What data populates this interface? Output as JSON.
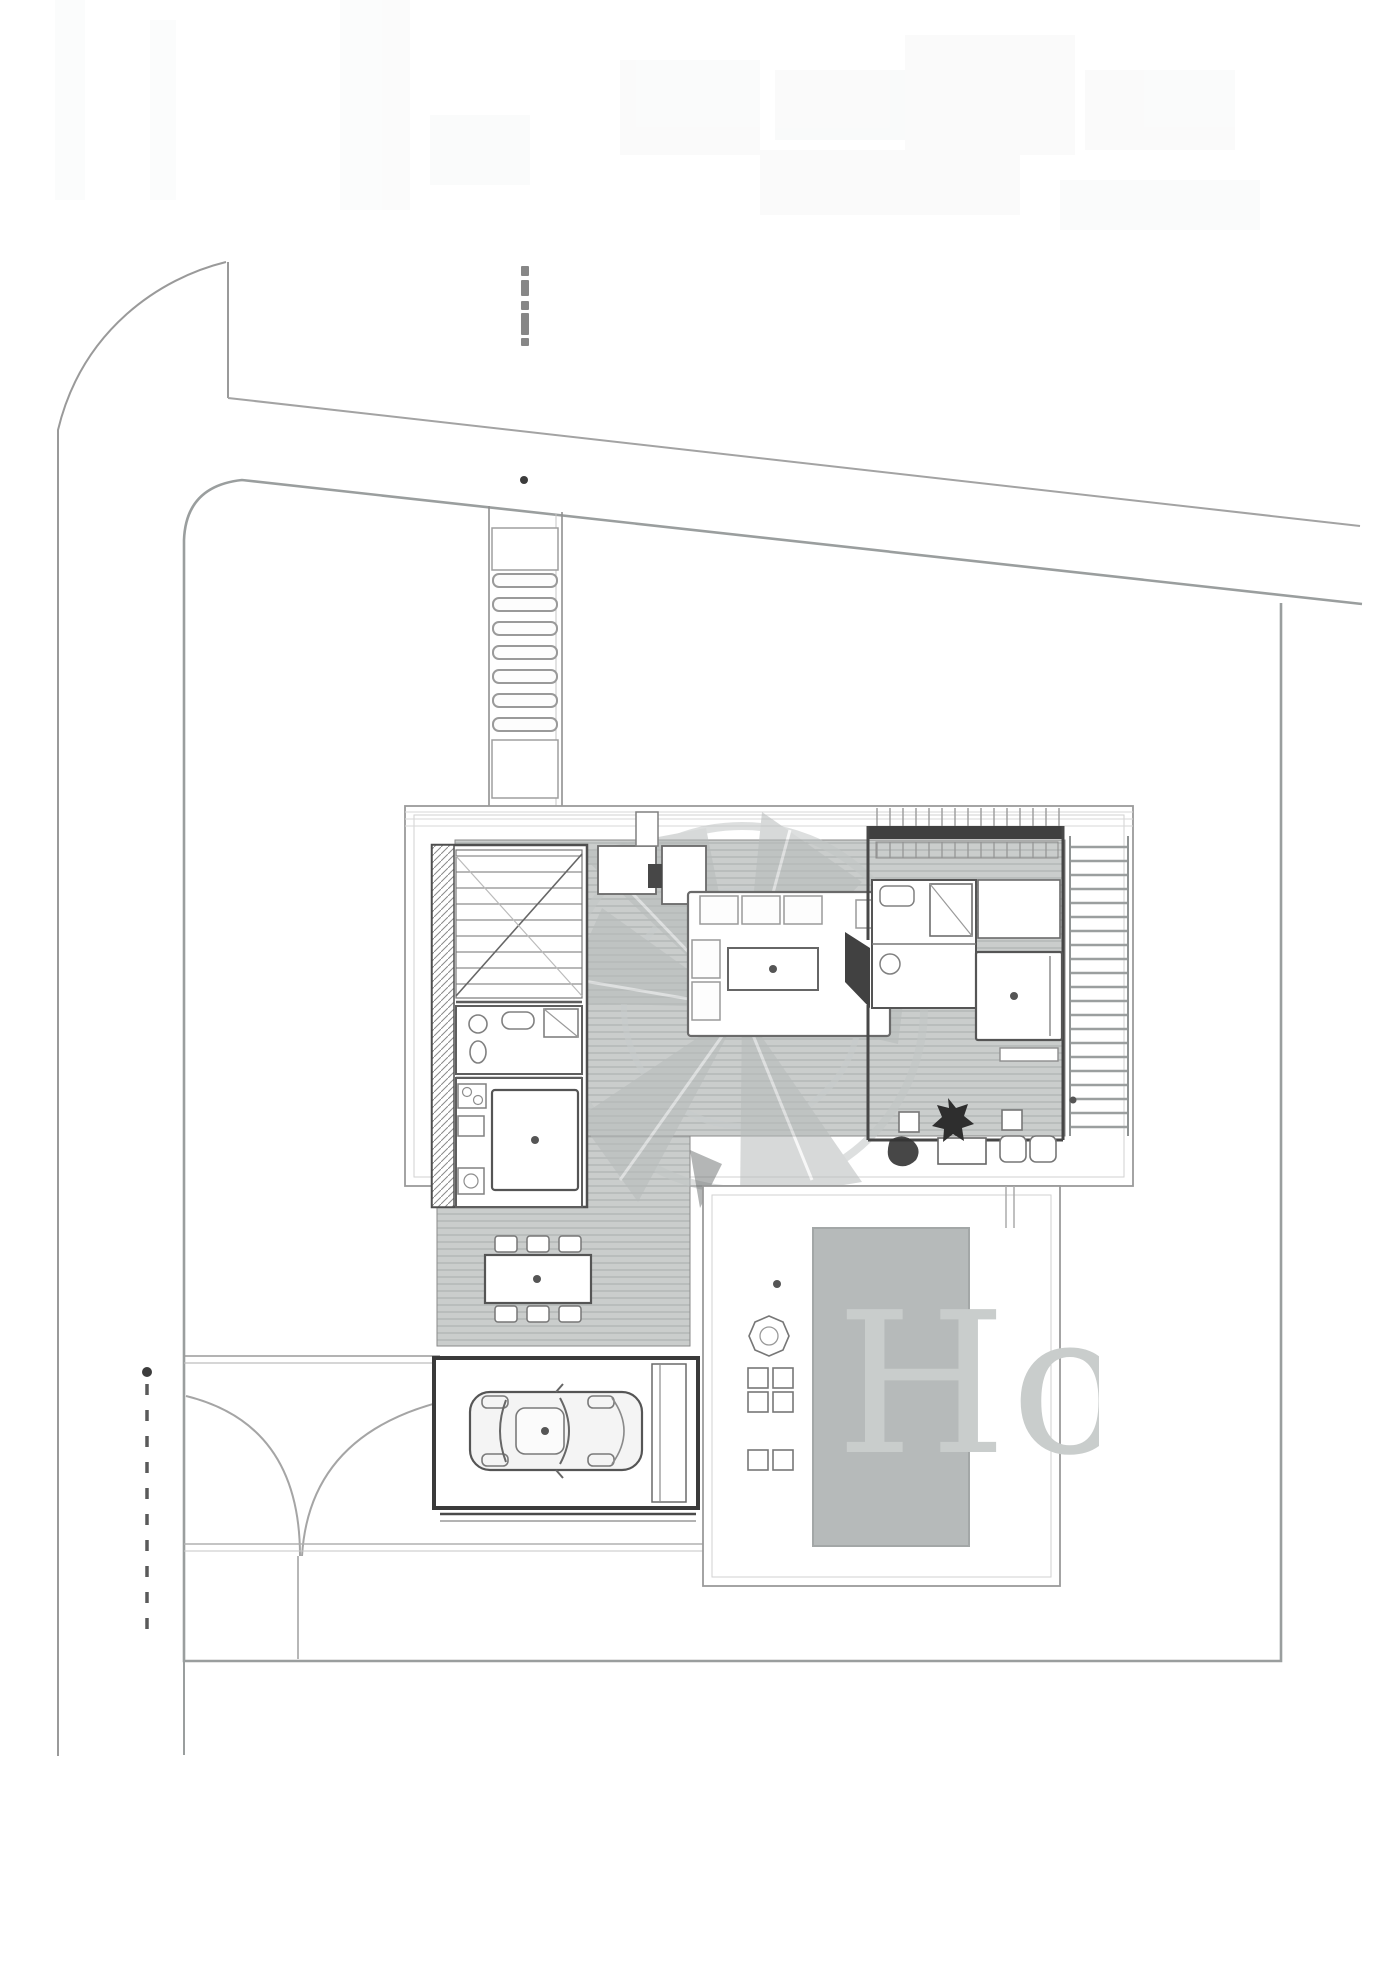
{
  "watermark": {
    "text": "Ho"
  },
  "palette": {
    "paper": "#ffffff",
    "line": "#8f8f8f",
    "line_light": "#c9c9c9",
    "boundary": "#9a9e9e",
    "deck_fill": "#cacdcc",
    "deck_line": "#b2b6b5",
    "wall_dark": "#3f3f3f",
    "pool": "#b6baba",
    "pool_edge": "#a3a7a7",
    "watermark_letter": "#c9cdcc",
    "watermark_petal": "#b7bbbb",
    "ink_dark": "#2c2c2c"
  }
}
